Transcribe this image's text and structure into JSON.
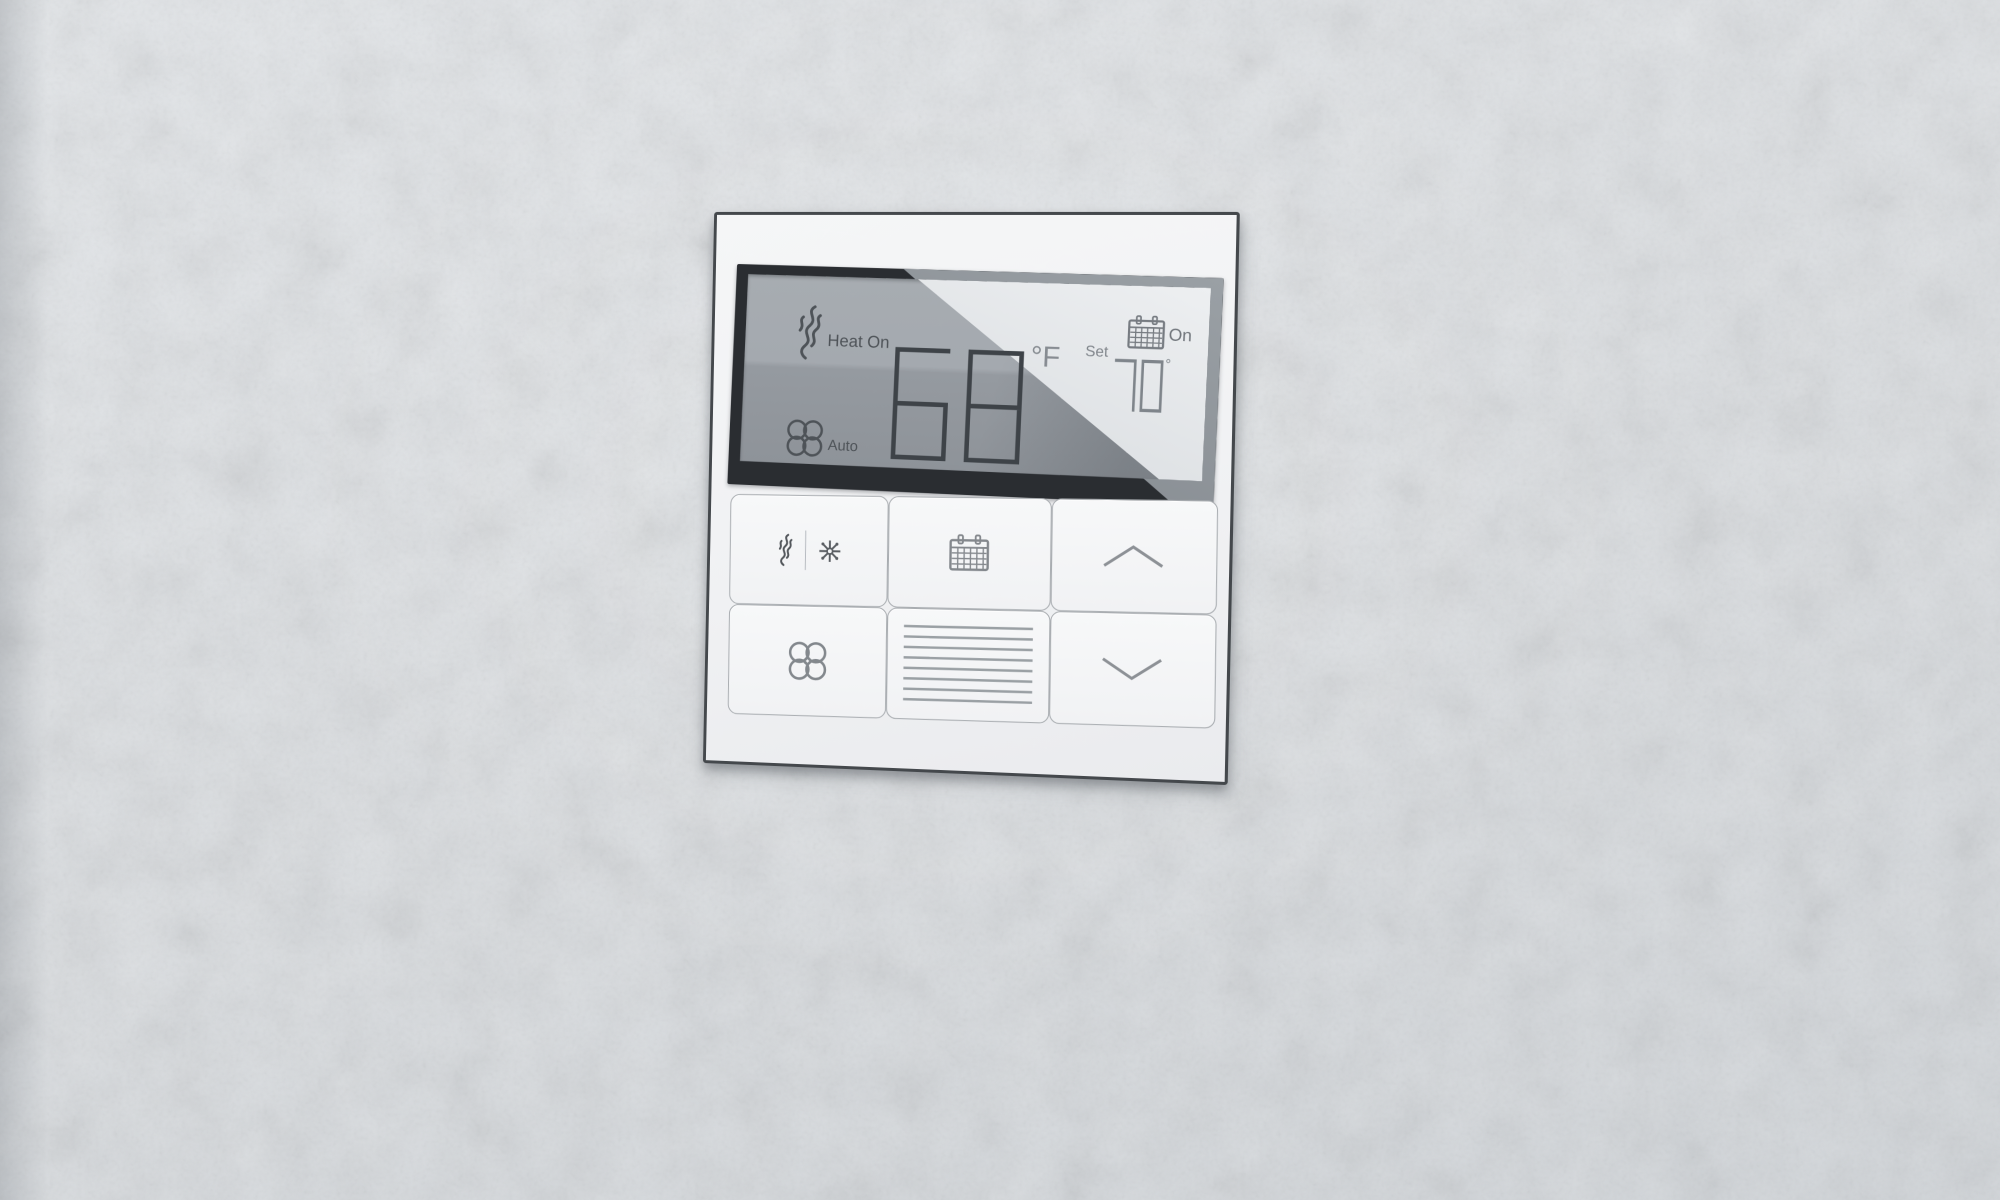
{
  "device": {
    "type": "wall thermostat"
  },
  "display": {
    "heat_status": "Heat On",
    "fan_mode": "Auto",
    "current_temp": "68",
    "unit": "°F",
    "set_label": "Set",
    "set_temp": "70",
    "set_degree": "°",
    "schedule_status": "On"
  },
  "buttons": {
    "mode": {
      "icons": [
        "flame-icon",
        "snowflake-icon"
      ]
    },
    "schedule": {
      "icon": "calendar-icon"
    },
    "temp_up": {
      "icon": "chevron-up-icon"
    },
    "fan": {
      "icon": "fan-icon"
    },
    "menu": {
      "icon": "horizontal-lines-icon"
    },
    "temp_down": {
      "icon": "chevron-down-icon"
    }
  },
  "colors": {
    "wall": "#dbdee1",
    "panel_face": "#f2f3f5",
    "panel_border": "#44484c",
    "bezel_dark": "#2a2d31",
    "lcd_gray": "#9aa0a6",
    "lcd_glare": "#e2e5e8",
    "glyph_dark": "#4e5358",
    "glyph_light": "#7f858b",
    "digit_dark": "#3e4348"
  }
}
